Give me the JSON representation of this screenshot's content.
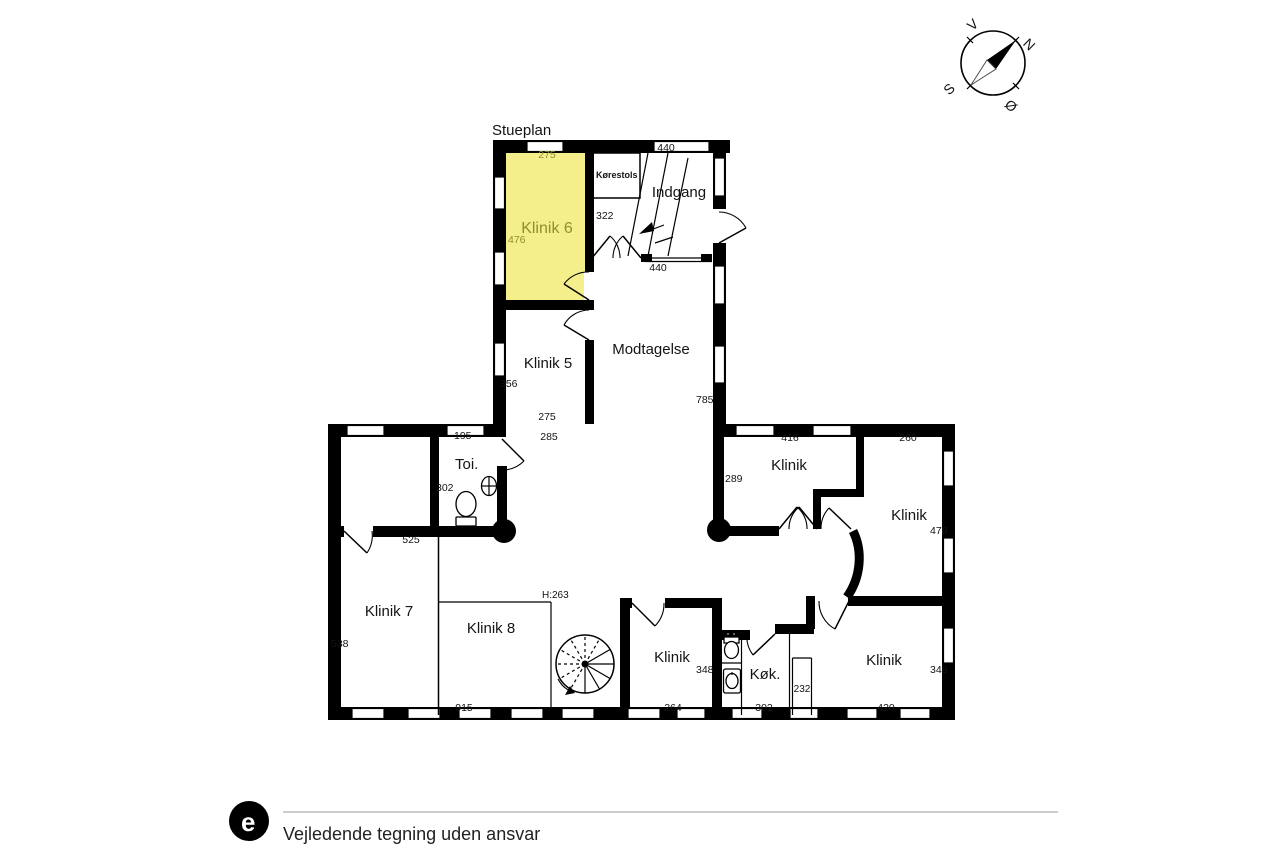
{
  "title": "Stueplan",
  "compass": {
    "n": "N",
    "s": "S",
    "v": "V",
    "o": "Ø"
  },
  "footer": {
    "disclaimer": "Vejledende tegning uden ansvar",
    "logo_letter": "e"
  },
  "colors": {
    "wall": "#000000",
    "highlight": "#f4ef8b",
    "highlight_text": "#8f8f2e"
  },
  "rooms": {
    "klinik6": {
      "label": "Klinik 6",
      "width": "275",
      "height": "476"
    },
    "korestols": {
      "label": "Kørestols"
    },
    "indgang": {
      "label": "Indgang",
      "width_top": "440",
      "wall": "322",
      "width_bottom": "440"
    },
    "klinik5": {
      "label": "Klinik 5",
      "height": "356",
      "width_inner": "275",
      "width_outer": "285"
    },
    "modtagelse": {
      "label": "Modtagelse",
      "height": "785"
    },
    "toi": {
      "label": "Toi.",
      "width": "195",
      "height": "302"
    },
    "klinik_ne": {
      "label": "Klinik",
      "width": "416",
      "height": "289"
    },
    "klinik_e": {
      "label": "Klinik",
      "width": "260",
      "height": "478"
    },
    "klinik7": {
      "label": "Klinik 7",
      "width": "525",
      "height": "538"
    },
    "klinik8": {
      "label": "Klinik 8",
      "ceiling": "H:263",
      "width": "915"
    },
    "klinik_s": {
      "label": "Klinik",
      "height": "348",
      "width": "264"
    },
    "kok": {
      "label": "Køk.",
      "width": "302",
      "hall": "232"
    },
    "klinik_se": {
      "label": "Klinik",
      "height": "349",
      "width": "420"
    }
  }
}
